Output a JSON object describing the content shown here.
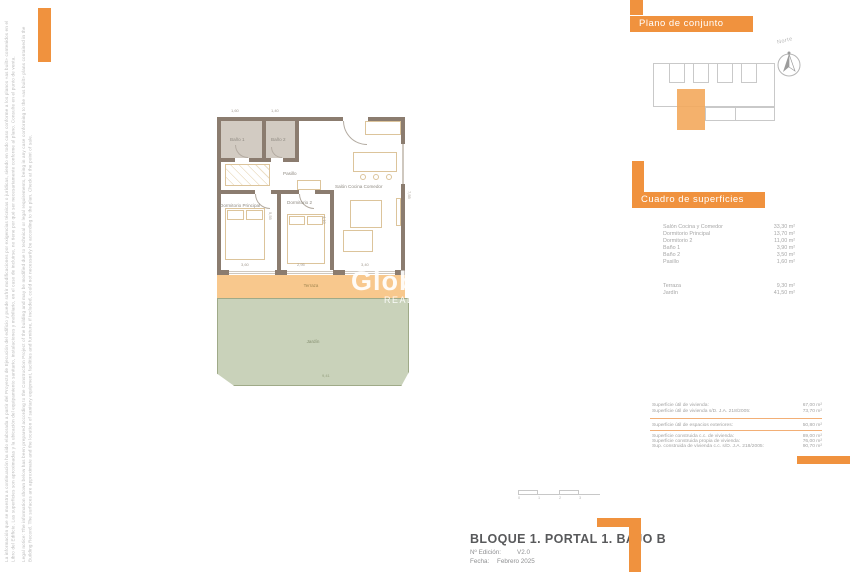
{
  "accent_color": "#F0923E",
  "disclaimer": {
    "es": "La información que se muestra a continuación ha sido elaborada a partir del Proyecto de Ejecución del edificio y puede sufrir modificaciones por exigencias técnicas o jurídicas, siendo en todo caso conforme a los planos «as built» contenidos en el Libro del Edificio. Las superficies son aproximadas y la ubicación del equipamiento sanitario, instalaciones y mobiliario, en el caso de incluirse, no tiene por qué ser necesariamente conforme al plano. Consulte en el punto de venta.",
    "en": "Legal notice: The information shown below has been prepared according to the Construction Project of the building and may be modified due to technical or legal requirements, being in any case conforming to the «as built» plans contained in the Building Record. The surfaces are approximate and the location of sanitary equipment, facilities and furniture, if included, could not necessarily be according to the plan. Check at the point of sale."
  },
  "site_plan": {
    "title": "Plano de conjunto",
    "compass_label": "Norte"
  },
  "surfaces_panel": {
    "title": "Cuadro de superficies",
    "interior_rows": [
      {
        "label": "Salón Cocina y Comedor",
        "value": "33,30 m²"
      },
      {
        "label": "Dormitorio Principal",
        "value": "13,70 m²"
      },
      {
        "label": "Dormitorio 2",
        "value": "11,00 m²"
      },
      {
        "label": "Baño 1",
        "value": "3,90 m²"
      },
      {
        "label": "Baño 2",
        "value": "3,50 m²"
      },
      {
        "label": "Pasillo",
        "value": "1,60 m²"
      }
    ],
    "exterior_rows": [
      {
        "label": "Terraza",
        "value": "9,30 m²"
      },
      {
        "label": "Jardín",
        "value": "41,50 m²"
      }
    ]
  },
  "summary_table": {
    "groups": [
      {
        "rows": [
          {
            "label": "Superficie útil de vivienda:",
            "value": "67,00 m²"
          },
          {
            "label": "Superficie útil de vivienda s/D. J.A. 218/2005:",
            "value": "73,70 m²"
          }
        ]
      },
      {
        "rows": [
          {
            "label": "Superficie útil de espacios exteriores:",
            "value": "50,80 m²"
          }
        ]
      },
      {
        "rows": [
          {
            "label": "Superficie construida c.c. de vivienda:",
            "value": "89,00 m²"
          },
          {
            "label": "Superficie construida propia de vivienda:",
            "value": "76,00 m²"
          },
          {
            "label": "Sup. construida de vivienda c.c. s/D. J.A. 218/2005:",
            "value": "90,70 m²"
          }
        ]
      }
    ]
  },
  "title_block": {
    "title": "BLOQUE 1. PORTAL 1. BAJO B",
    "edition_label": "Nº Edición:",
    "edition_value": "V2.0",
    "date_label": "Fecha:",
    "date_value": "Febrero 2025"
  },
  "floor_plan": {
    "rooms": {
      "bath1": "Baño 1",
      "bath2": "Baño 2",
      "hall": "Pasillo",
      "bedroom_main": "Dormitorio Principal",
      "bedroom2": "Dormitorio 2",
      "living": "Salón Cocina Comedor",
      "terrace": "Terraza",
      "garden": "Jardín"
    },
    "dimensions": {
      "top1": "1,60",
      "top2": "1,40",
      "bottom1": "3,60",
      "bottom2": "2,95",
      "bottom3": "3,40",
      "right_v": "7,55",
      "bed_main_v": "5,55",
      "bed2_v": "4,10",
      "garden_w": "9,41"
    },
    "watermark": {
      "line1": "Glob",
      "line2": "REAL"
    }
  },
  "scale_bar": {
    "labels": [
      "0",
      "1",
      "2",
      "3"
    ]
  }
}
